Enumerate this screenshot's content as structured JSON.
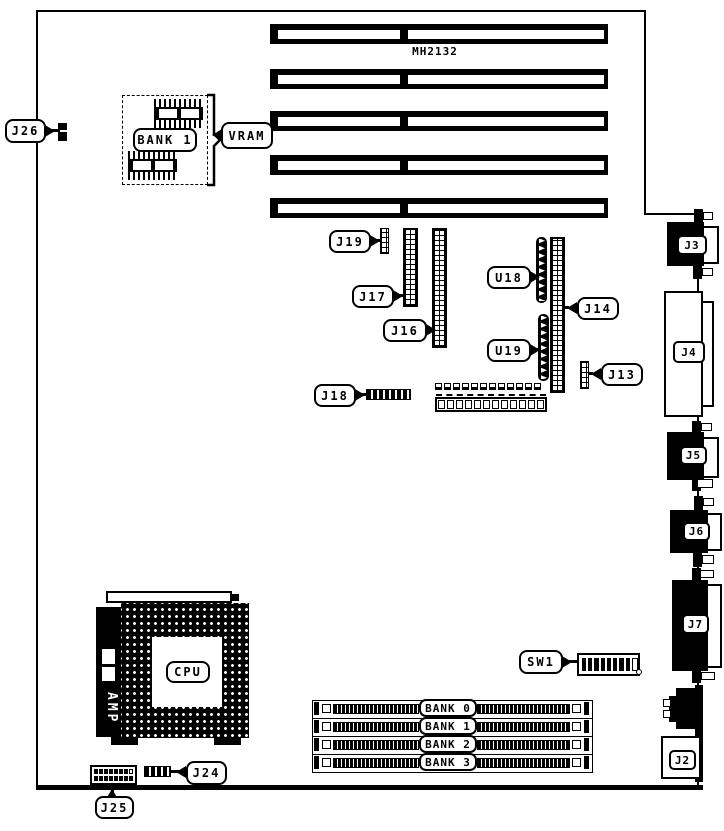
{
  "diagram": {
    "board_model": "MH2132",
    "ink_color": "#000000",
    "background_color": "#ffffff"
  },
  "labels": {
    "j26": "J26",
    "bank1_group": "BANK 1",
    "vram": "VRAM",
    "j19": "J19",
    "j17": "J17",
    "j16": "J16",
    "u18": "U18",
    "u19": "U19",
    "j14": "J14",
    "j13": "J13",
    "j18": "J18",
    "sw1": "SW1",
    "j3": "J3",
    "j4": "J4",
    "j5": "J5",
    "j6": "J6",
    "j7": "J7",
    "j2": "J2",
    "cpu": "CPU",
    "amp": "AMP",
    "j24": "J24",
    "j25": "J25"
  },
  "memory_banks": [
    "BANK 0",
    "BANK 1",
    "BANK 2",
    "BANK 3"
  ]
}
